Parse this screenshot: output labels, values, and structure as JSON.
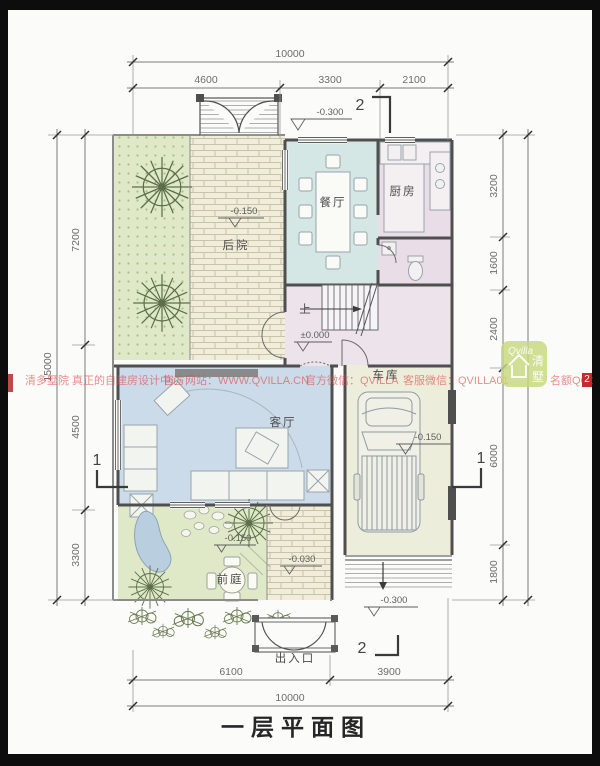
{
  "title": "一层平面图",
  "rooms": {
    "backyard": "后院",
    "dining": "餐厅",
    "kitchen": "厨房",
    "living": "客厅",
    "garage": "车库",
    "frontyard": "前庭",
    "entrance": "出入口",
    "stairs_up": "上"
  },
  "levels": {
    "top_gate": "-0.300",
    "backyard": "-0.150",
    "hall": "±0.000",
    "garage": "-0.150",
    "frontyard": "-0.150",
    "path": "-0.030",
    "ramp": "-0.300"
  },
  "dimensions": {
    "top_total": "10000",
    "top_segments": [
      "4600",
      "3300",
      "2100"
    ],
    "bottom_segments": [
      "6100",
      "3900"
    ],
    "bottom_total": "10000",
    "left_total": "15000",
    "left_segments": [
      "7200",
      "4500",
      "3300"
    ],
    "right_segments": [
      "3200",
      "1600",
      "2400",
      "6000",
      "1800"
    ]
  },
  "section_marks": {
    "top": "2",
    "bottom": "2",
    "west": "1",
    "east": "1"
  },
  "watermark": {
    "line1": "清多墅院 真正的自建房设计中心",
    "site_label": "官方网站：WWW.QVILLA.CN",
    "wechat_label": "官方微信：QVILLA",
    "service_label": "客服微信：QVILLA01",
    "qq_label": "名额QQ：",
    "qq_value": "2",
    "logo_script": "Qvilla",
    "logo_char_top": "清",
    "logo_char_bottom": "墅"
  },
  "colors": {
    "dining": "#d4e7e5",
    "kitchen_bath_hall": "#e9dde8",
    "living": "#ccdbe9",
    "garage": "#ededdb",
    "yard_green": "#dfe9c8",
    "paving": "#f0edda",
    "wall": "#4f4f4f",
    "watermark_red": "#db4848"
  }
}
